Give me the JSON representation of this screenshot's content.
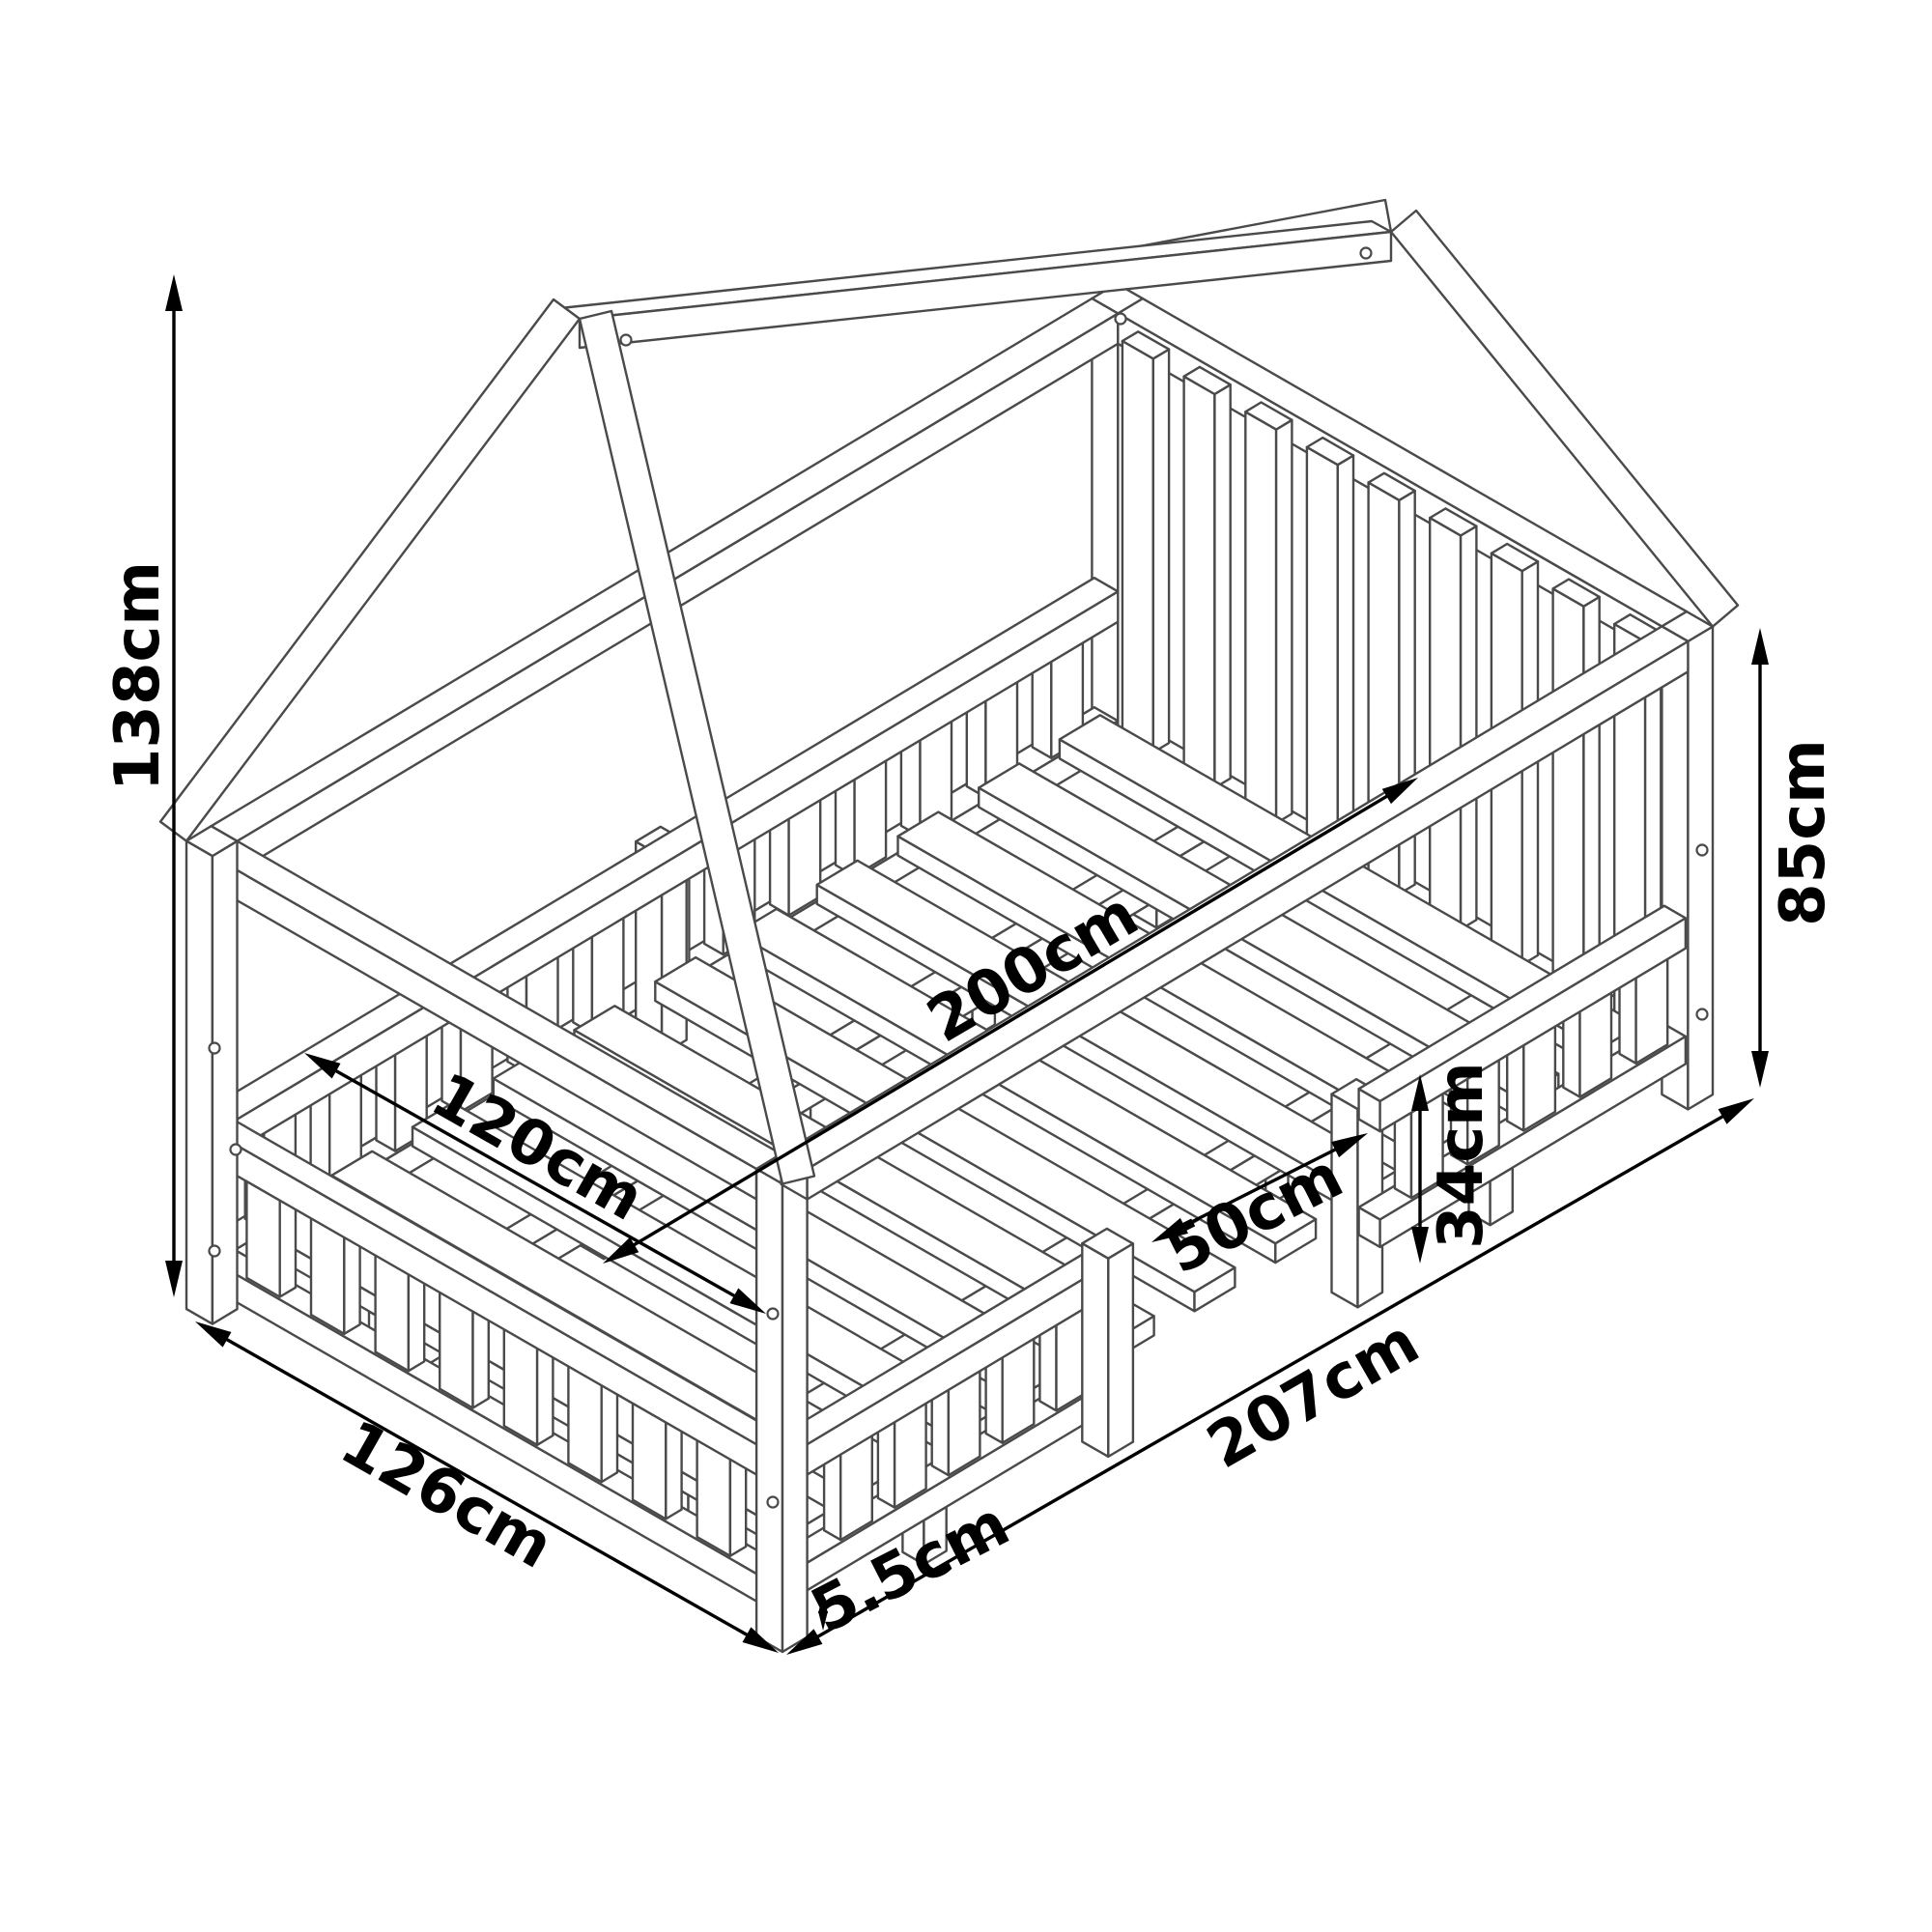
{
  "diagram": {
    "kind": "isometric technical line drawing",
    "subject": "house-frame floor bed with guard rails and slatted base",
    "background_color": "#ffffff",
    "line_color": "#4a4a4a",
    "dimension_color": "#000000"
  },
  "dims": {
    "total_height": "138cm",
    "side_height": "85cm",
    "bed_length": "200cm",
    "bed_width": "120cm",
    "entry_opening": "50cm",
    "rail_height": "34cm",
    "outer_width": "126cm",
    "outer_length": "207cm",
    "base_clearance": "5.5cm"
  }
}
